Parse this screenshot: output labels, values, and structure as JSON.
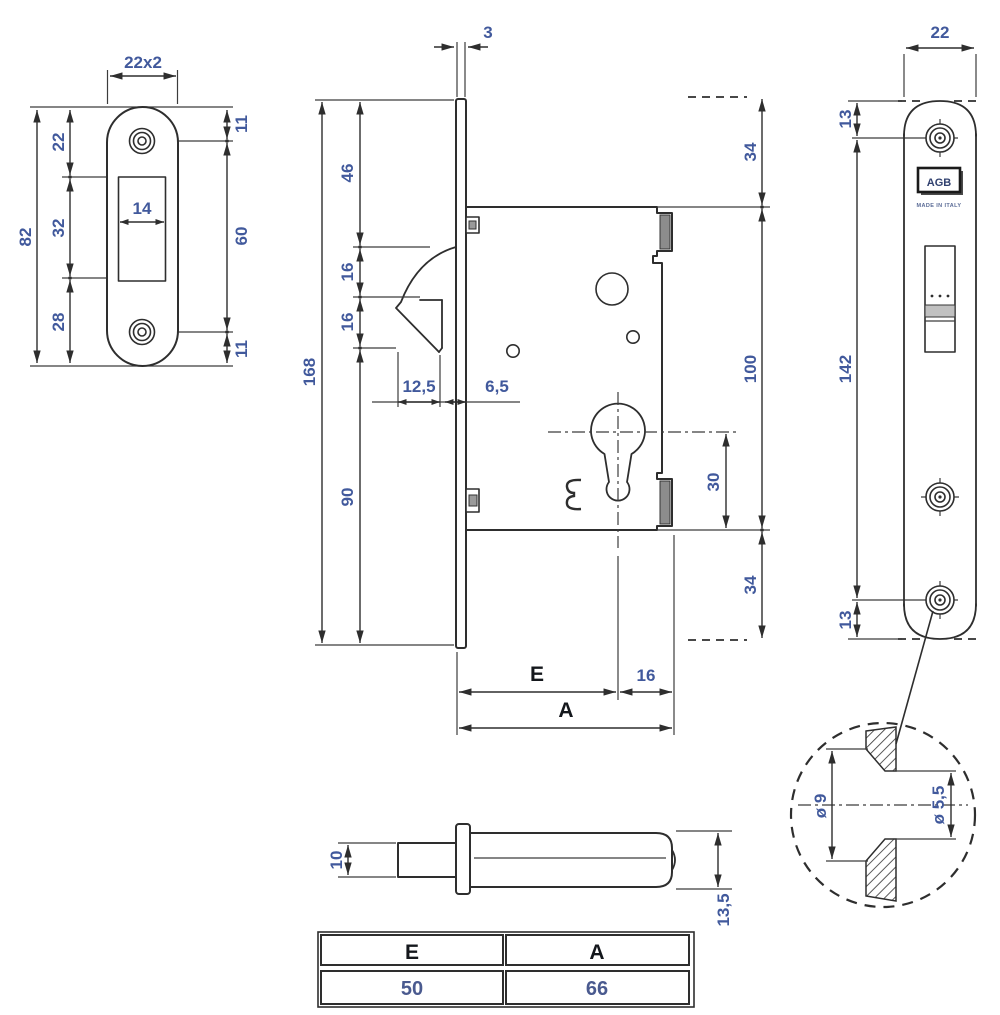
{
  "colors": {
    "dimension_text": "#41599c",
    "line": "#2e2e2e",
    "label_text": "#14171c"
  },
  "drawing": {
    "strike_plate": {
      "width": "22x2",
      "overall": "82",
      "top": "22",
      "middle": "32",
      "bottom": "28",
      "cutout": "14",
      "right_top": "11",
      "screw_span": "60",
      "right_bottom": "11"
    },
    "lock_body": {
      "plate_thk": "3",
      "top_seg": "46",
      "hook_seg1": "16",
      "hook_seg2": "16",
      "overall": "168",
      "bottom_seg": "90",
      "hook_depth": "12,5",
      "gap": "6,5",
      "above": "34",
      "height": "100",
      "cyl_bottom": "30",
      "below": "34",
      "backset": "E",
      "cyl_edge": "16",
      "total_width": "A"
    },
    "faceplate": {
      "width": "22",
      "top": "13",
      "span": "142",
      "bottom": "13",
      "logo": "AGB",
      "origin": "MADE IN ITALY"
    },
    "detail": {
      "outer": "ø 9",
      "bore": "ø 5,5"
    },
    "bolt": {
      "tail": "10",
      "height": "13,5"
    },
    "table": {
      "headers": [
        "E",
        "A"
      ],
      "values": [
        "50",
        "66"
      ]
    }
  }
}
